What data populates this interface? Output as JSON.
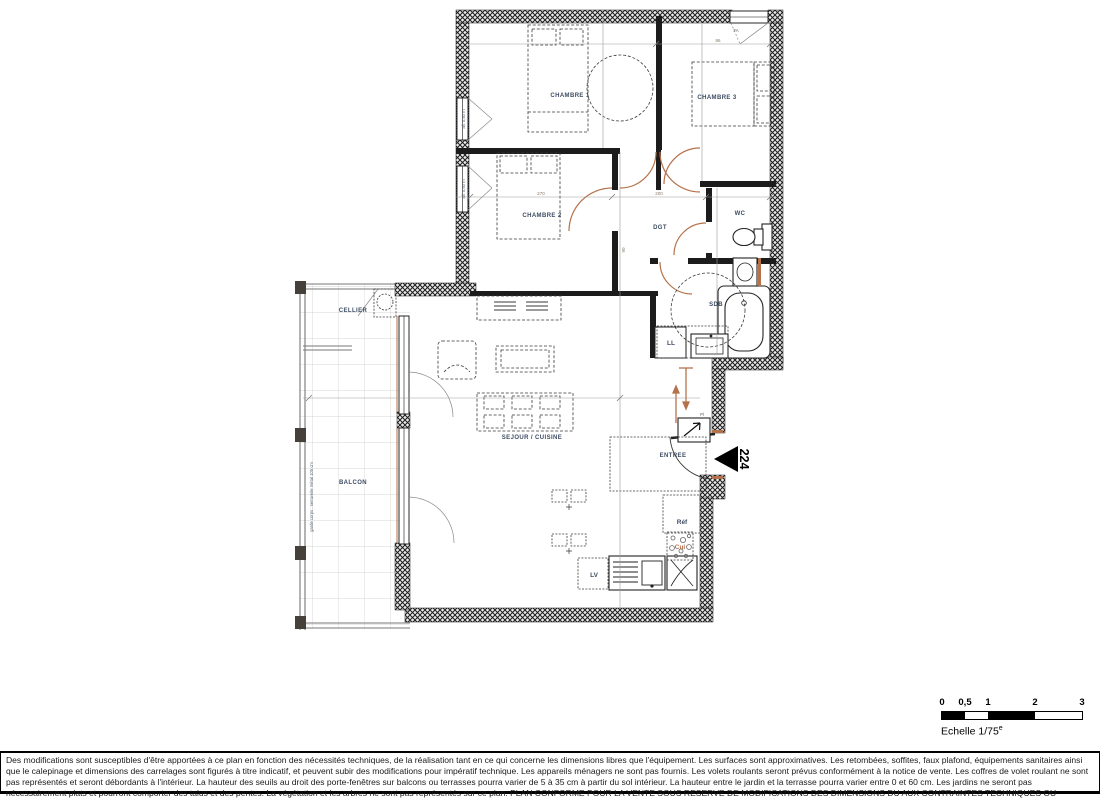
{
  "plan": {
    "rooms": {
      "chambre1": "CHAMBRE 1",
      "chambre2": "CHAMBRE 2",
      "chambre3": "CHAMBRE 3",
      "wc": "WC",
      "sdb": "SDB",
      "dgt": "DGT",
      "cellier": "CELLIER",
      "balcon": "BALCON",
      "sejour": "SEJOUR / CUISINE",
      "entree": "ENTREE"
    },
    "appliances": {
      "ll": "LL",
      "lv": "LV",
      "ref": "Réf",
      "cui": "Cui"
    },
    "annotations": {
      "apartment_number": "224",
      "window_sill_1": "all. 0,50 m",
      "window_sill_2": "all. 0,50 m",
      "guardrail": "garde corps : serrurerie métal 105 cm",
      "window_fa": "FA",
      "closet": "Pl"
    },
    "dimensions": {
      "d270": "270",
      "d200": "200",
      "d90": "90",
      "d86": "86"
    }
  },
  "scale_bar": {
    "tick_0": "0",
    "tick_05": "0,5",
    "tick_1": "1",
    "tick_2": "2",
    "tick_3": "3",
    "label": "Echelle 1/75",
    "label_sup": "e"
  },
  "footer": {
    "disclaimer": "Des modifications sont susceptibles d'être apportées à ce plan en fonction des nécessités techniques, de la réalisation tant en ce qui concerne les dimensions libres que l'équipement. Les surfaces sont approximatives. Les retombées, soffites, faux plafond, équipements sanitaires ainsi que le calepinage et dimensions des carrelages sont figurés à titre indicatif, et peuvent subir des modifications pour impératif technique. Les appareils ménagers ne sont pas fournis. Les volets roulants seront prévus conformément à la notice de vente. Les coffres de volet roulant ne sont pas représentés et seront débordants à l'intérieur. La hauteur des seuils au droit des porte-fenêtres sur balcons ou terrasses pourra varier de 5 à 35 cm à partir du sol intérieur. La hauteur entre le jardin et la terrasse pourra varier entre 0 et 60 cm. Les jardins ne seront pas nécessairement plats et pourront comporter des talus et des pentes. La végétation et les arbres ne sont pas représentés sur ce plan. PLAN CONFORME POUR LA VENTE SOUS RESERVE DE MODIFICATIONS DES DIMENSIONS DU AUX CONTRAINTES TECHNIQUES OU DIMENSIONELLES EN COURS D'EXECUTION DE CHANTIER. LE MOBILIER N'EST QUE REPRESENTATIF ET NON FOURNI."
  },
  "colors": {
    "door_accent": "#b5724a",
    "wall": "#1c1c1c",
    "room_label": "#3d4c63"
  }
}
